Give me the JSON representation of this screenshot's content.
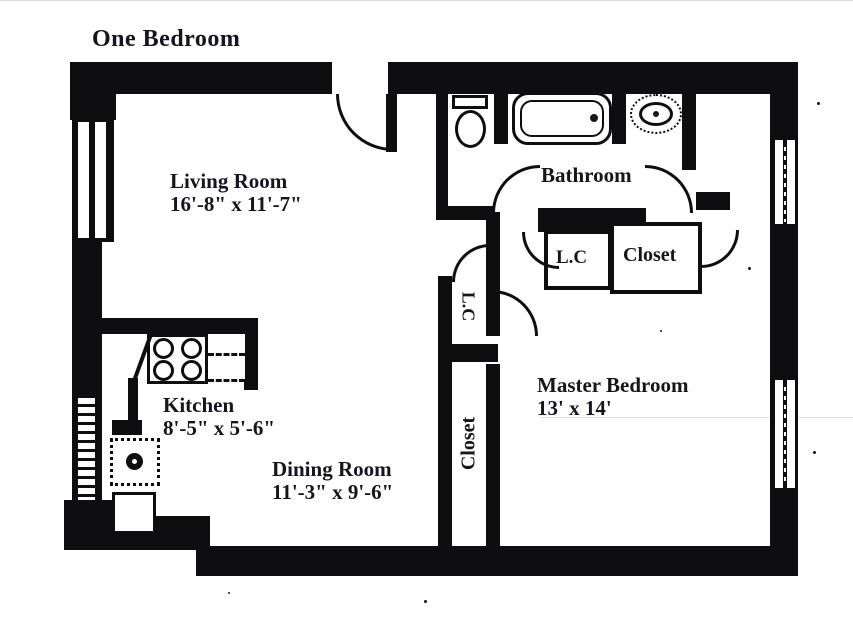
{
  "title": "One Bedroom",
  "rooms": {
    "living": {
      "name": "Living Room",
      "dims": "16'-8\" x 11'-7\""
    },
    "bathroom": {
      "name": "Bathroom"
    },
    "linen_hall": {
      "name": "L.C"
    },
    "closet_hall": {
      "name": "Closet"
    },
    "linen_vertical": {
      "name": "L.C"
    },
    "kitchen": {
      "name": "Kitchen",
      "dims": "8'-5\" x 5'-6\""
    },
    "dining": {
      "name": "Dining Room",
      "dims": "11'-3\" x 9'-6\""
    },
    "closet_vertical": {
      "name": "Closet"
    },
    "master": {
      "name": "Master Bedroom",
      "dims": "13' x 14'"
    }
  },
  "fixtures": [
    "toilet",
    "bathtub",
    "bathroom-sink",
    "stove",
    "kitchen-counter",
    "kitchen-sink",
    "kitchen-cabinet"
  ],
  "colors": {
    "wall": "#0e0e10",
    "paper": "#ffffff",
    "ink": "#15151d"
  }
}
